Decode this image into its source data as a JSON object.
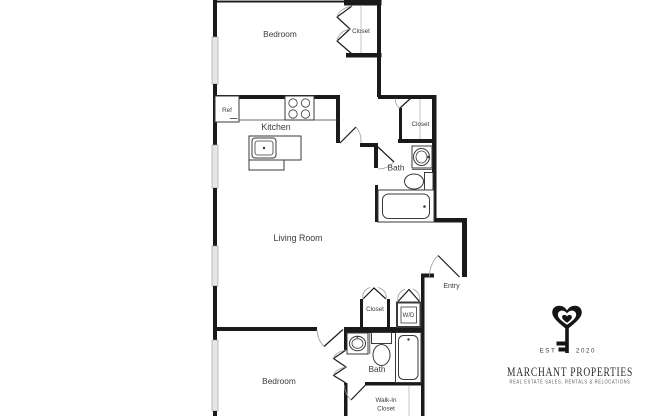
{
  "rooms": {
    "bedroom_top": "Bedroom",
    "bedroom_closet": "Closet",
    "kitchen": "Kitchen",
    "fridge": "Ref",
    "hall_closet": "Closet",
    "bath_upper": "Bath",
    "living_room": "Living Room",
    "entry": "Entry",
    "laundry_closet": "Closet",
    "washer_dryer": "W/D",
    "bath_lower": "Bath",
    "walk_in_closet_line1": "Walk-In",
    "walk_in_closet_line2": "Closet",
    "bedroom_bottom": "Bedroom"
  },
  "logo": {
    "est_label": "EST",
    "year": "2020",
    "company_name": "MARCHANT PROPERTIES",
    "tagline": "REAL ESTATE SALES, RENTALS & RELOCATIONS",
    "icon": "heart-key-icon"
  },
  "colors": {
    "wall": "#1a1a1a",
    "window": "#e6e6e6",
    "door_arc": "#9a9a9a",
    "fixture_outline": "#3a3a3a",
    "label_text": "#3a3a3a",
    "logo_text": "#2c2d31",
    "background": "#ffffff"
  }
}
